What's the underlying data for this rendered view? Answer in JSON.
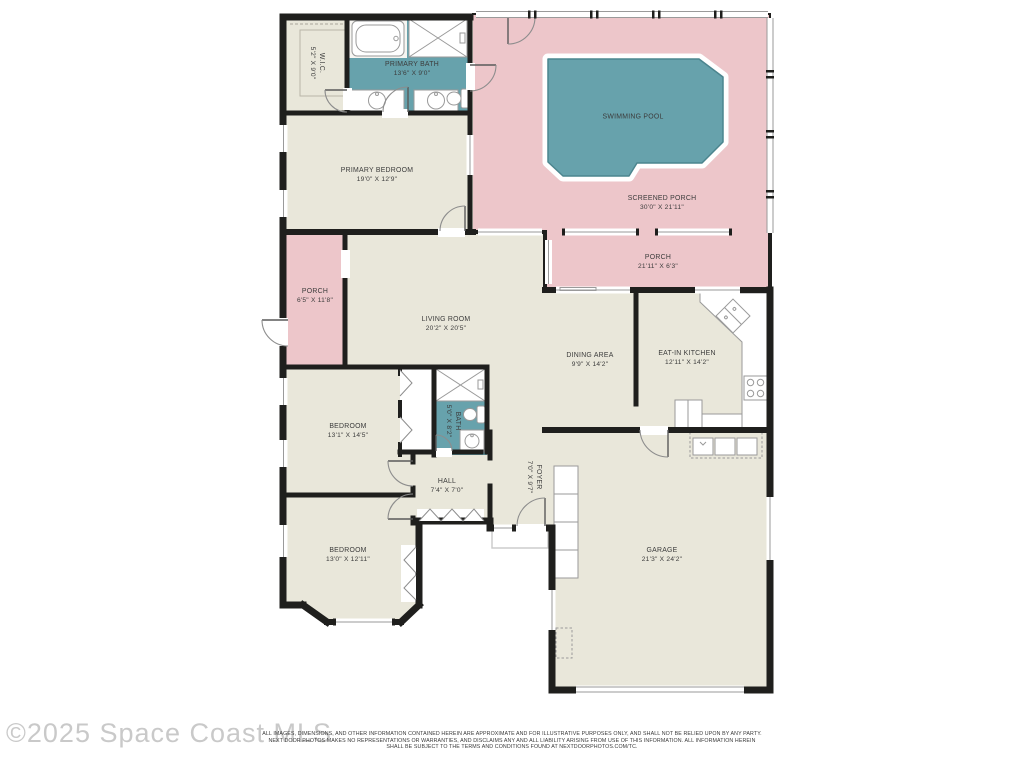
{
  "colors": {
    "wall": "#1f1f1d",
    "room": "#e9e7da",
    "porch": "#edc6ca",
    "water": "#67a2ac",
    "water-dark": "#4c858e",
    "line": "#9a9a9a",
    "text": "#3c3c3c"
  },
  "rooms": [
    {
      "id": "wic",
      "name": "W.I.C.",
      "dims": "5'2\" X 9'0\""
    },
    {
      "id": "primary-bath",
      "name": "PRIMARY BATH",
      "dims": "13'6\" X 9'0\""
    },
    {
      "id": "swimming-pool",
      "name": "SWIMMING POOL",
      "dims": ""
    },
    {
      "id": "screened-porch",
      "name": "SCREENED PORCH",
      "dims": "30'0\" X 21'11\""
    },
    {
      "id": "primary-bedroom",
      "name": "PRIMARY BEDROOM",
      "dims": "19'0\" X 12'9\""
    },
    {
      "id": "porch-left",
      "name": "PORCH",
      "dims": "6'5\" X 11'8\""
    },
    {
      "id": "porch-rear",
      "name": "PORCH",
      "dims": "21'11\" X 6'3\""
    },
    {
      "id": "living-room",
      "name": "LIVING ROOM",
      "dims": "20'2\" X 20'5\""
    },
    {
      "id": "dining-area",
      "name": "DINING AREA",
      "dims": "9'9\" X 14'2\""
    },
    {
      "id": "eat-in-kitchen",
      "name": "EAT-IN KITCHEN",
      "dims": "12'11\" X 14'2\""
    },
    {
      "id": "bedroom-1",
      "name": "BEDROOM",
      "dims": "13'1\" X 14'5\""
    },
    {
      "id": "bath",
      "name": "BATH",
      "dims": "5'0\" X 8'2\""
    },
    {
      "id": "hall",
      "name": "HALL",
      "dims": "7'4\" X 7'0\""
    },
    {
      "id": "bedroom-2",
      "name": "BEDROOM",
      "dims": "13'0\" X 12'11\""
    },
    {
      "id": "foyer",
      "name": "FOYER",
      "dims": "7'0\" X 9'7\""
    },
    {
      "id": "garage",
      "name": "GARAGE",
      "dims": "21'3\" X 24'2\""
    }
  ],
  "fixtures": [
    "bathtub-icon",
    "shower-icon",
    "sink-icon",
    "toilet-icon",
    "kitchen-sink-icon",
    "stove-icon",
    "refrigerator-icon",
    "washer-dryer-icon",
    "water-heater-icon",
    "storage-shelves-icon",
    "closet-doors-icon",
    "garage-door",
    "front-stoop",
    "door-arc",
    "window"
  ],
  "footer": {
    "watermark": "©2025 Space Coast MLS",
    "disclaimer": [
      "ALL IMAGES, DIMENSIONS, AND OTHER INFORMATION CONTAINED HEREIN ARE APPROXIMATE AND FOR ILLUSTRATIVE PURPOSES ONLY, AND SHALL NOT BE RELIED UPON BY ANY PARTY.",
      "NEXT DOOR PHOTOS MAKES NO REPRESENTATIONS OR WARRANTIES, AND DISCLAIMS ANY AND ALL LIABILITY ARISING FROM USE OF THIS INFORMATION. ALL INFORMATION HEREIN",
      "SHALL BE SUBJECT TO THE TERMS AND CONDITIONS FOUND AT NEXTDOORPHOTOS.COM/TC."
    ]
  }
}
